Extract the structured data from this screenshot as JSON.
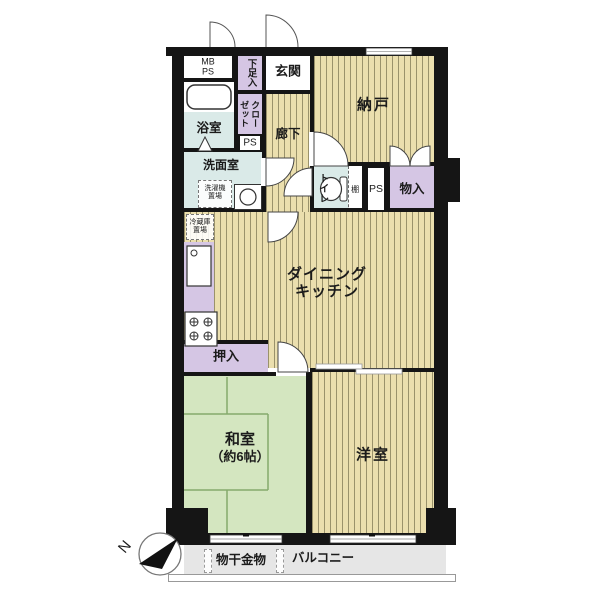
{
  "rooms": {
    "mb_ps_line1": "MB",
    "mb_ps_line2": "PS",
    "shoe_cupboard": "下足入",
    "entrance": "玄関",
    "storage_room": "納戸",
    "bathroom": "浴室",
    "closet_col_right": "クロー",
    "closet_col_left": "ゼット",
    "pipe_space_1": "PS",
    "corridor": "廊下",
    "washroom": "洗面室",
    "washer_area_line1": "洗濯機",
    "washer_area_line2": "置場",
    "toilet": "トイレ",
    "shelf": "棚",
    "pipe_space_2": "PS",
    "storage_closet": "物入",
    "fridge_area_line1": "冷蔵庫",
    "fridge_area_line2": "置場",
    "dining_kitchen_line1": "ダイニング",
    "dining_kitchen_line2": "キッチン",
    "futon_closet": "押入",
    "japanese_room_line1": "和室",
    "japanese_room_line2": "（約6帖）",
    "western_room": "洋室"
  },
  "balcony": {
    "label": "バルコニー",
    "laundry_hardware": "物干金物"
  },
  "compass": {
    "north_label": "N"
  },
  "palette": {
    "floor_tan": "#ebdfae",
    "floor_stripe": "#9a926b",
    "closet_purple": "#d5c6e4",
    "wet_area_blue": "#daeae8",
    "tatami_green": "#d4e6c0",
    "tatami_line": "#85aa6c",
    "balcony_gray": "#e6e6e6",
    "wall_black": "#151515"
  }
}
